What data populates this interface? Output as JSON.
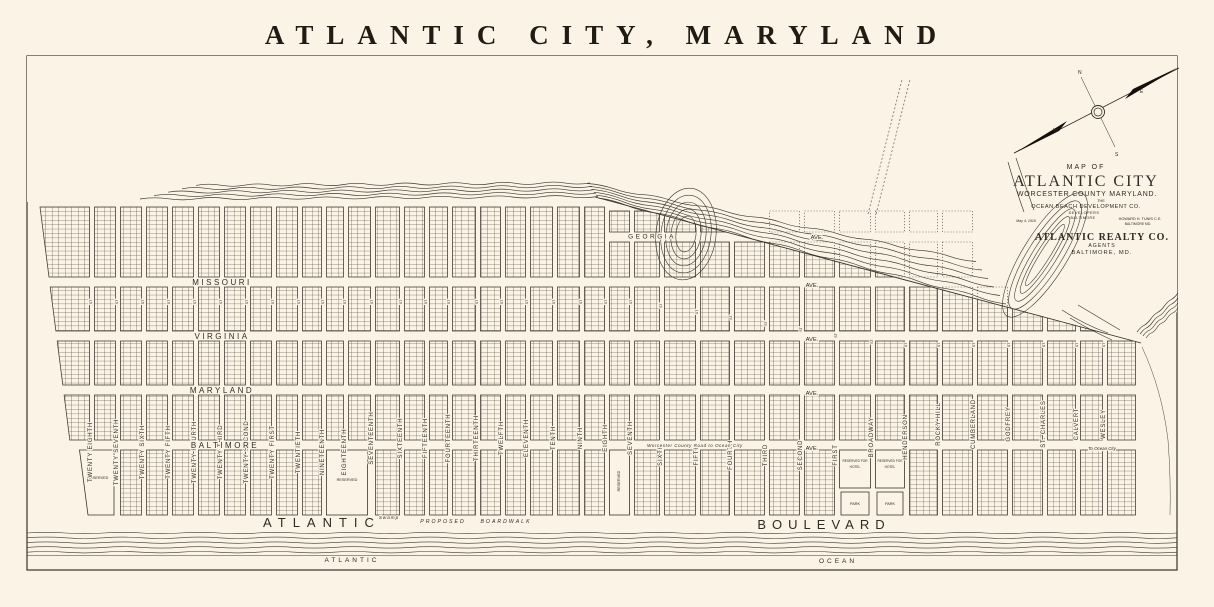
{
  "title": "ATLANTIC CITY, MARYLAND",
  "map": {
    "water": {
      "mainland": "MAINLAND",
      "sinepuxent": "SINEPUXENT",
      "bay": "BAY"
    },
    "avenues": [
      {
        "name": "GEORGIA",
        "suffix": "AVE."
      },
      {
        "name": "MISSOURI",
        "suffix": "AVE."
      },
      {
        "name": "VIRGINIA",
        "suffix": "AVE."
      },
      {
        "name": "MARYLAND",
        "suffix": "AVE."
      },
      {
        "name": "BALTIMORE",
        "suffix": "AVE."
      }
    ],
    "streets": [
      "TWENTY EIGHTH",
      "TWENTY SEVENTH",
      "TWENTY SIXTH",
      "TWENTY FIFTH",
      "TWENTY FOURTH",
      "TWENTY THIRD",
      "TWENTY SECOND",
      "TWENTY FIRST",
      "TWENTIETH",
      "NINETEENTH",
      "EIGHTEENTH",
      "SEVENTEENTH",
      "SIXTEENTH",
      "FIFTEENTH",
      "FOURTEENTH",
      "THIRTEENTH",
      "TWELFTH",
      "ELEVENTH",
      "TENTH",
      "NINTH",
      "EIGHTH",
      "SEVENTH",
      "SIXTH",
      "FIFTH",
      "FOURTH",
      "THIRD",
      "SECOND",
      "FIRST",
      "BROADWAY",
      "HENDERSON",
      "ROCKY HILL",
      "CUMBERLAND",
      "GODFREY",
      "ST. CHARLES",
      "CALVERT",
      "WESLEY"
    ],
    "street_suffix": "ST",
    "boulevard": {
      "left": "ATLANTIC",
      "right": "BOULEVARD"
    },
    "boardwalk": {
      "swamp": "Swamp",
      "proposed": "PROPOSED",
      "boardwalk": "BOARDWALK"
    },
    "ocean": {
      "left": "ATLANTIC",
      "right": "OCEAN"
    },
    "blocks": {
      "reserved": "RESERVED",
      "reserved_for": "RESERVED FOR",
      "hotel": "HOTEL",
      "park": "PARK"
    },
    "annotations": {
      "county_road": "Worcester County Road to Ocean City",
      "to_ocean_city": "To Ocean City"
    },
    "credit": {
      "map_of": "MAP OF",
      "city": "ATLANTIC CITY",
      "county": "WORCESTER COUNTY MARYLAND.",
      "the": "THE",
      "company": "OCEAN BEACH DEVELOPMENT CO.",
      "developers": "DEVELOPERS",
      "company_city": "BALTIMORE",
      "date": "May 4, 1916",
      "engineer": "HOWARD H. TUNIS C.E.",
      "engineer_city": "BALTIMORE MD.",
      "agent": "ATLANTIC REALTY CO.",
      "agents": "AGENTS",
      "agent_city": "BALTIMORE, MD."
    },
    "compass": {
      "n": "N",
      "e": "E",
      "s": "S",
      "w": "W"
    }
  }
}
